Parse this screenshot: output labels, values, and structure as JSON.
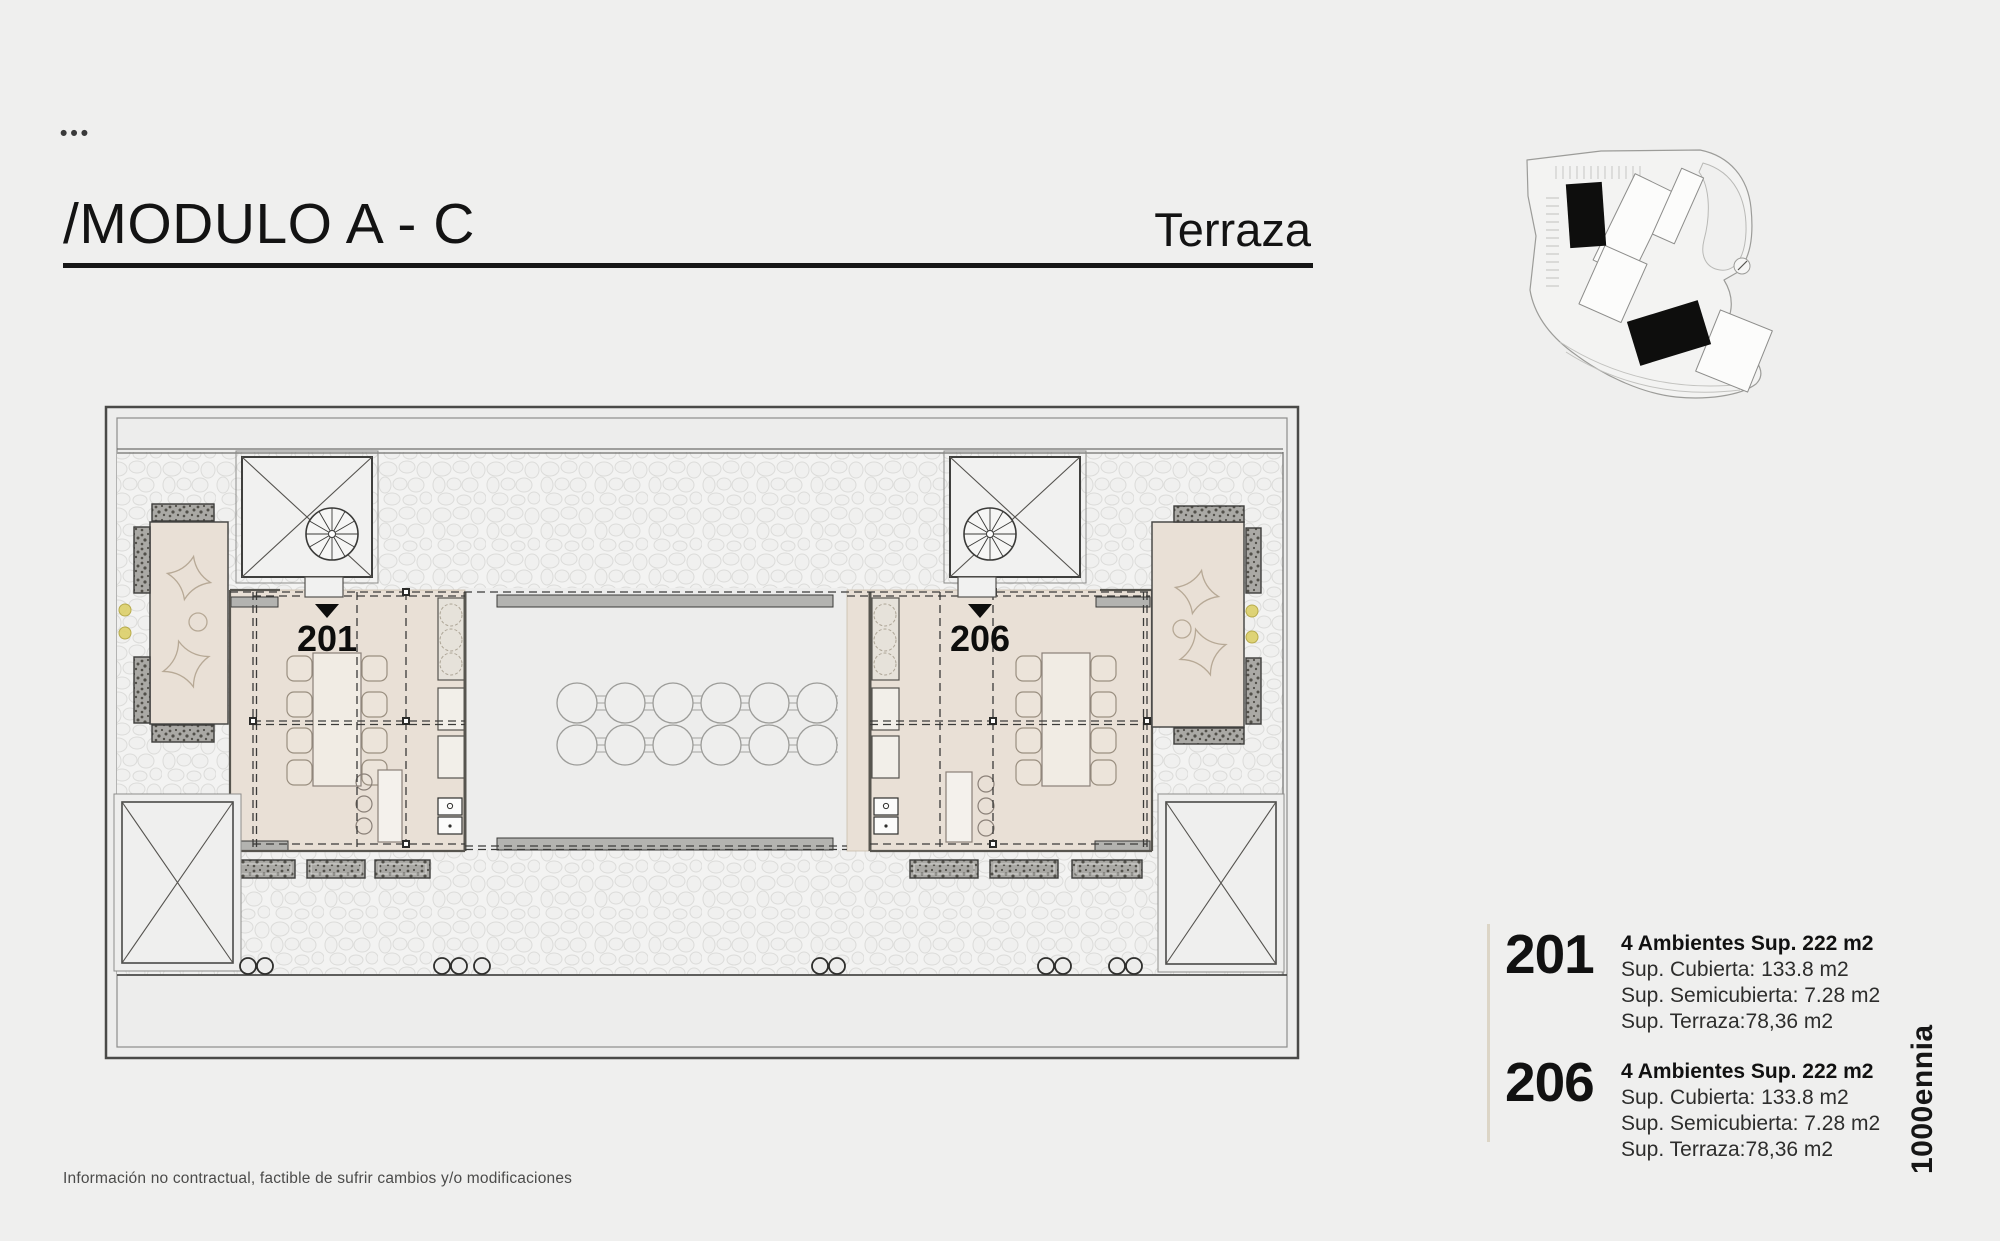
{
  "header": {
    "dots": "•••",
    "title": "/MODULO A - C",
    "subtitle": "Terraza"
  },
  "plan": {
    "labels": {
      "left": "201",
      "right": "206"
    },
    "colors": {
      "background": "#efefee",
      "unit_fill": "#e9e0d6",
      "planter_fill": "#aaa9a5",
      "highlight_black": "#0e0e0d"
    }
  },
  "units": [
    {
      "number": "201",
      "title": "4 Ambientes Sup. 222 m2",
      "rows": [
        "Sup. Cubierta: 133.8 m2",
        "Sup. Semicubierta: 7.28 m2",
        "Sup. Terraza:78,36 m2"
      ]
    },
    {
      "number": "206",
      "title": "4 Ambientes Sup. 222 m2",
      "rows": [
        "Sup. Cubierta: 133.8 m2",
        "Sup. Semicubierta: 7.28 m2",
        "Sup. Terraza:78,36 m2"
      ]
    }
  ],
  "footer": {
    "disclaimer": "Información no contractual, factible de sufrir cambios y/o modificaciones"
  },
  "logo": {
    "text": "1000ennia"
  }
}
